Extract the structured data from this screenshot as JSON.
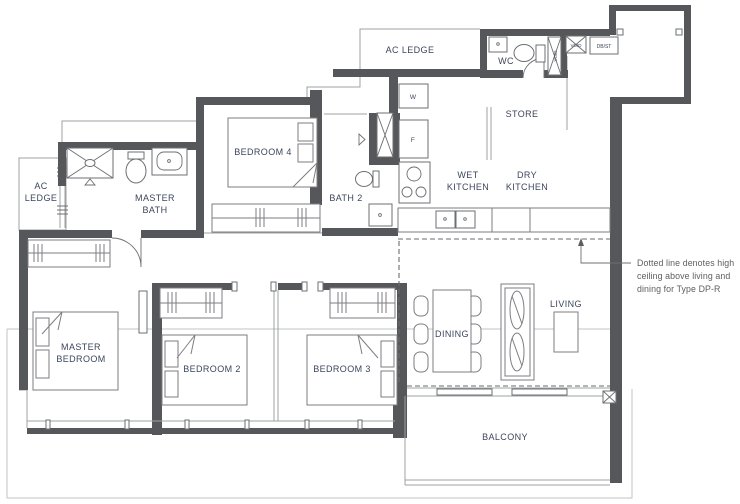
{
  "plan": {
    "rooms": {
      "ac_ledge_top": "AC LEDGE",
      "wc": "WC",
      "store": "STORE",
      "wet_kitchen_1": "WET",
      "wet_kitchen_2": "KITCHEN",
      "dry_kitchen_1": "DRY",
      "dry_kitchen_2": "KITCHEN",
      "bath2": "BATH 2",
      "bedroom4": "BEDROOM 4",
      "master_bath_1": "MASTER",
      "master_bath_2": "BATH",
      "ac_ledge_left_1": "AC",
      "ac_ledge_left_2": "LEDGE",
      "master_bedroom_1": "MASTER",
      "master_bedroom_2": "BEDROOM",
      "bedroom2": "BEDROOM 2",
      "bedroom3": "BEDROOM 3",
      "dining": "DINING",
      "living": "LIVING",
      "balcony": "BALCONY"
    },
    "fixtures": {
      "washer": "W",
      "fridge": "F",
      "db_st": "DB/ST",
      "void_shaft": "VOID",
      "void_box": "VOID"
    },
    "annotation": {
      "line1": "Dotted line denotes high",
      "line2": "ceiling above living and",
      "line3": "dining for Type DP-R"
    },
    "colors": {
      "wall": "#56575b",
      "label_text": "#3b465c",
      "annotation_text": "#5d5e60"
    }
  }
}
